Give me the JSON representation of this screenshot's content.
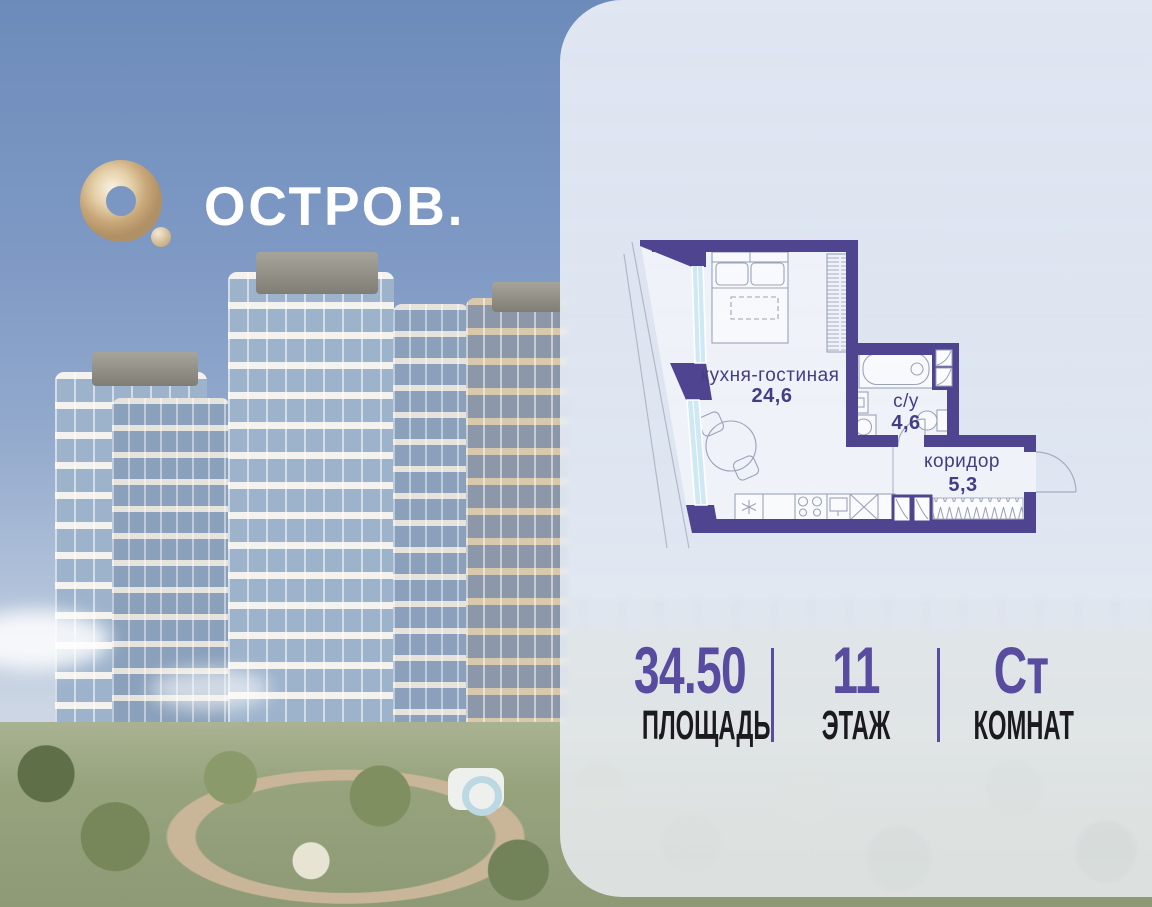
{
  "brand": {
    "title": "ОСТРОВ."
  },
  "floorplan": {
    "rooms": [
      {
        "label": "кухня-гостиная",
        "area": "24,6"
      },
      {
        "label": "с/у",
        "area": "4,6"
      },
      {
        "label": "коридор",
        "area": "5,3"
      }
    ]
  },
  "stats": {
    "area": {
      "value": "34.50",
      "label": "ПЛОЩАДЬ"
    },
    "floor": {
      "value": "11",
      "label": "ЭТАЖ"
    },
    "rooms": {
      "value": "Ст",
      "label": "КОМНАТ"
    }
  },
  "colors": {
    "wall_purple": "#4e4490",
    "accent_purple": "#574ca0",
    "logo_gold": "#d4b88c",
    "window_glass": "#cfe9f4",
    "panel": "#ecf0f8"
  }
}
